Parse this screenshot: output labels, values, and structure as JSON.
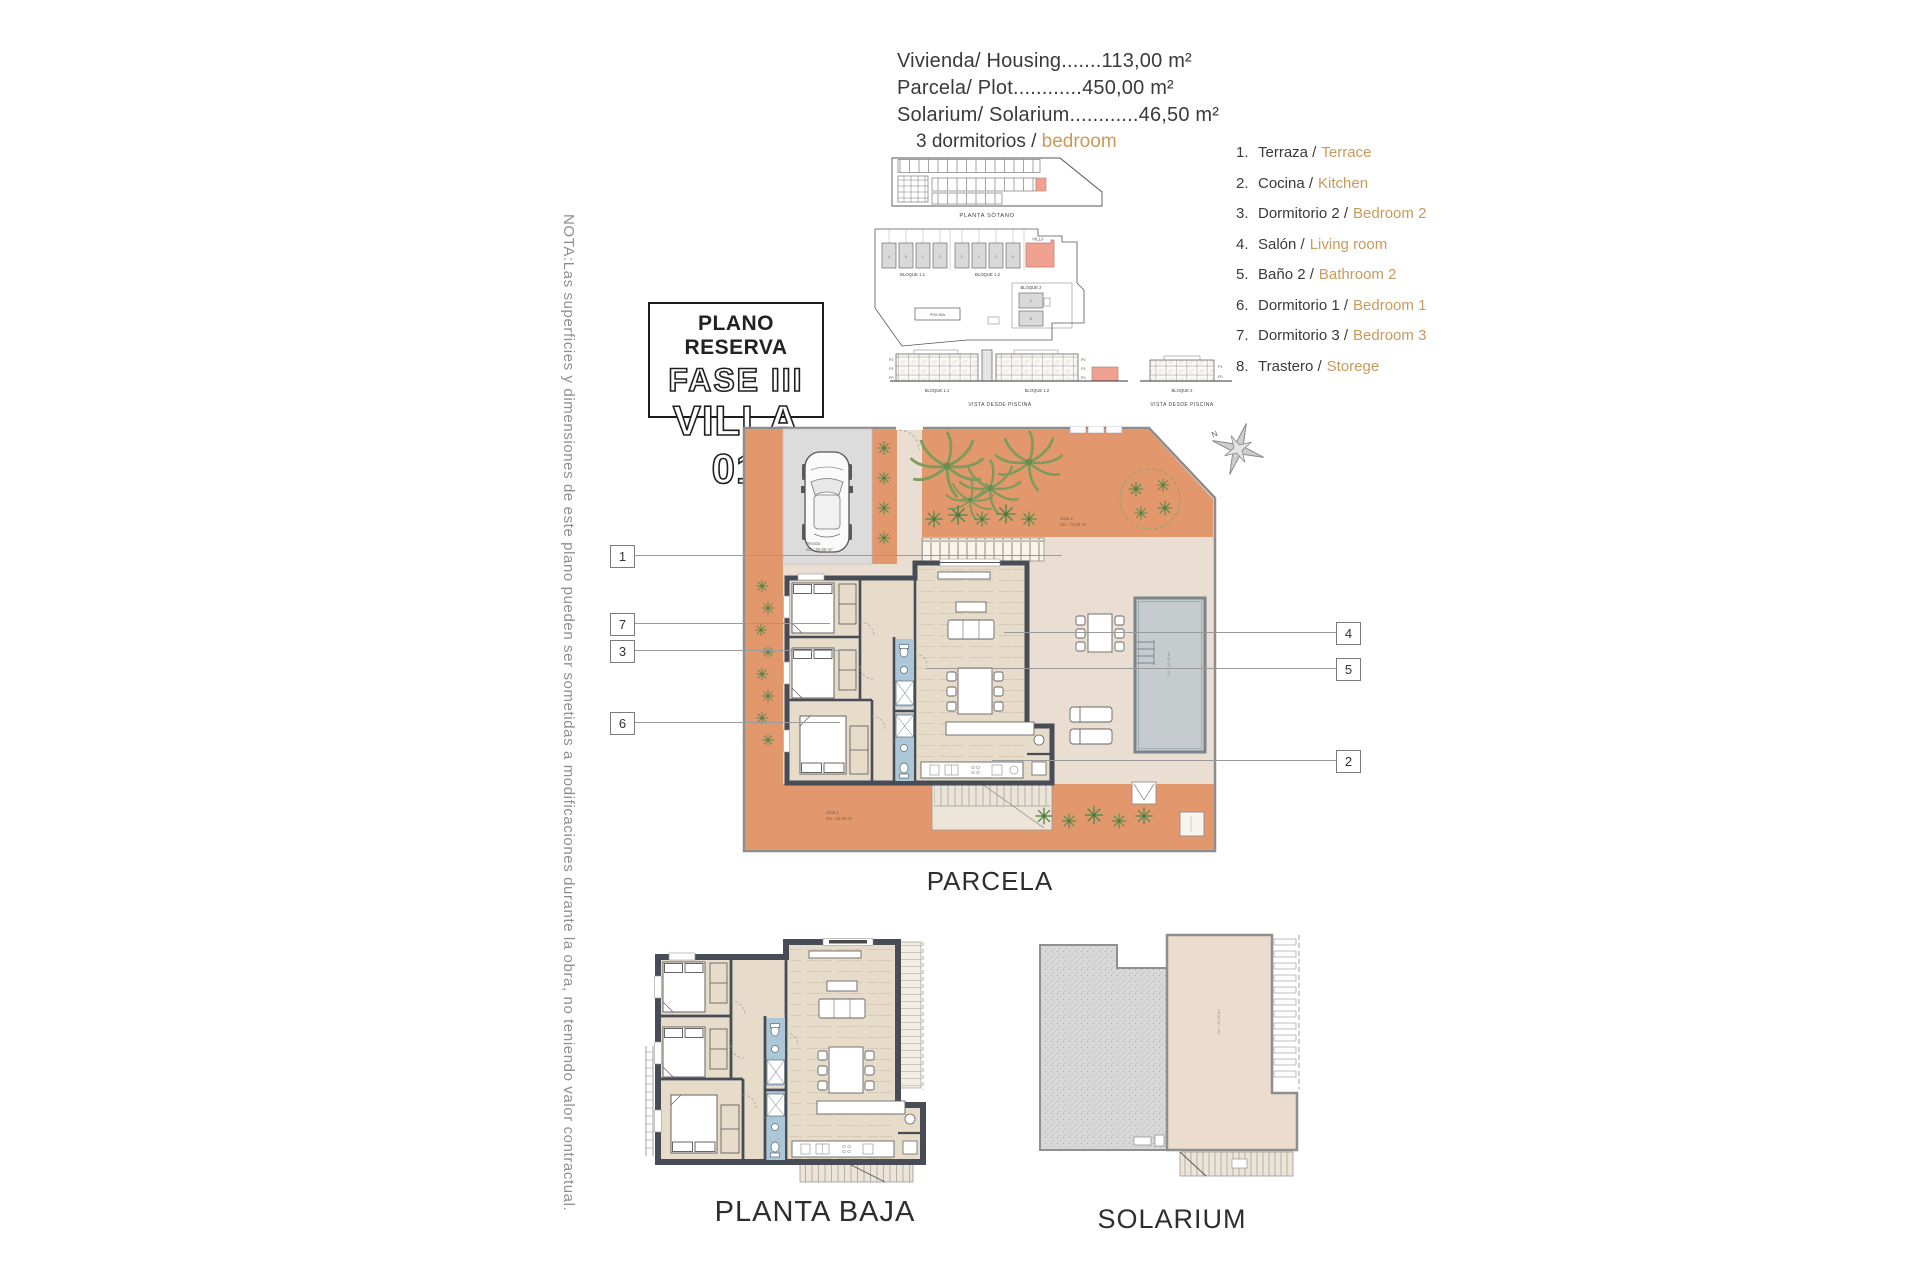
{
  "header": {
    "lines": [
      "Vivienda/ Housing.......113,00 m²",
      "Parcela/ Plot............450,00 m²",
      "Solarium/ Solarium............46,50 m²"
    ]
  },
  "bedrooms_label": {
    "es": "3 dormitorios /",
    "en": "bedroom"
  },
  "title_box": {
    "line1": "PLANO RESERVA",
    "line2": "FASE III",
    "line3": "VILLA 01"
  },
  "note_vertical": "NOTA:Las superficies y dimensiones de este plano pueden ser sometidas a modificaciones durante la obra, no teniendo valor contractual.",
  "legend": {
    "items": [
      {
        "num": "1.",
        "es": "Terraza /",
        "en": "Terrace"
      },
      {
        "num": "2.",
        "es": "Cocina /",
        "en": "Kitchen"
      },
      {
        "num": "3.",
        "es": "Dormitorio 2 /",
        "en": "Bedroom 2"
      },
      {
        "num": "4.",
        "es": "Salón /",
        "en": "Living room"
      },
      {
        "num": "5.",
        "es": "Baño 2 /",
        "en": "Bathroom 2"
      },
      {
        "num": "6.",
        "es": "Dormitorio 1 /",
        "en": "Bedroom 1"
      },
      {
        "num": "7.",
        "es": "Dormitorio 3 /",
        "en": "Bedroom 3"
      },
      {
        "num": "8.",
        "es": "Trastero /",
        "en": "Storege"
      }
    ]
  },
  "site": {
    "basement_caption": "PLANTA SÓTANO",
    "bloque11": "BLOQUE 1.1",
    "bloque12": "BLOQUE 1.2",
    "villa": "VILLA",
    "bloque2": "BLOQUE 2",
    "piscina": "PISCINA",
    "vista_caption": "VISTA DESDE PISCINA",
    "floors": [
      "P2",
      "P1",
      "P0"
    ],
    "units_b11": [
      "A",
      "B",
      "C",
      "D"
    ],
    "units_b12": [
      "E",
      "F",
      "G",
      "H"
    ],
    "units_b2": [
      "A",
      "B"
    ]
  },
  "parcela": {
    "label": "PARCELA",
    "terraza_name": "Terraza",
    "terraza_su": "SU : 55,00 m²",
    "zona2_name": "zona 2",
    "zona2_su": "SU : 70,00 m²",
    "zona1_name": "zona 1",
    "zona1_su": "SU : 62,00 m²",
    "compass_n": "N",
    "callouts_left": [
      "1",
      "7",
      "3",
      "6"
    ],
    "callouts_right": [
      "4",
      "5",
      "2"
    ]
  },
  "planta_baja": {
    "label": "PLANTA BAJA"
  },
  "solarium": {
    "label": "SOLARIUM",
    "area_note": "SU : 46,50 m²"
  },
  "colors": {
    "accent_text_orange": "#c9995a",
    "terrace_orange": "#e2986c",
    "plot_beige": "#e9ded1",
    "wall_dark": "#474c56",
    "bath_blue": "#abc7d8",
    "pool_gray": "#c6cbcd",
    "highlight_salmon": "#f1a192"
  }
}
